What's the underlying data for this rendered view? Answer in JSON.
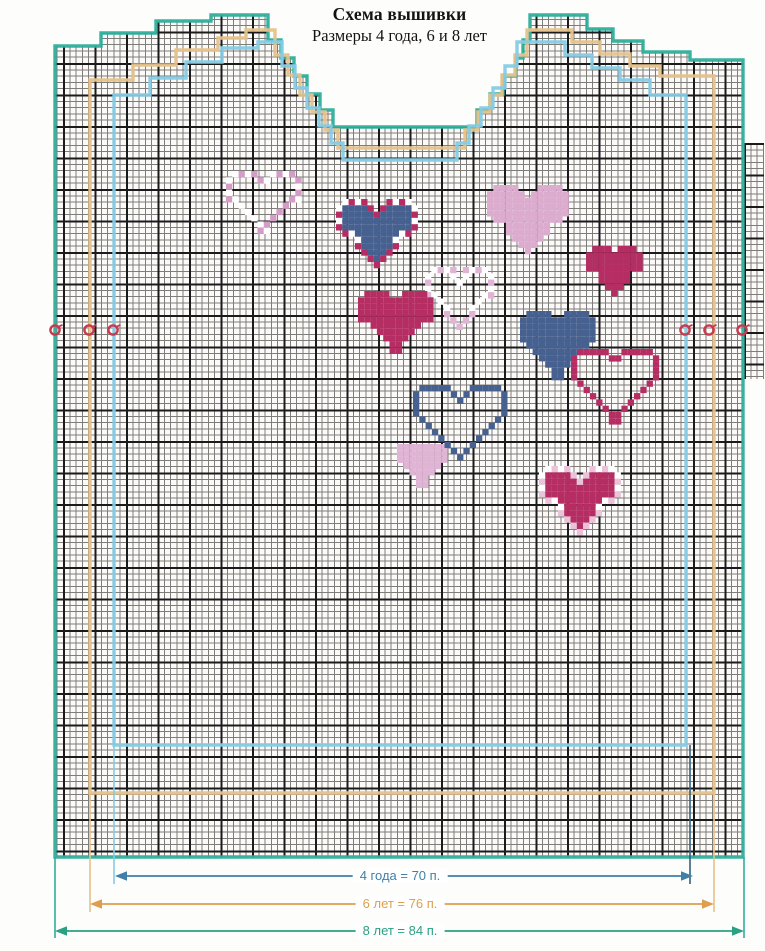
{
  "title": {
    "line1": "Схема вышивки",
    "line2": "Размеры 4 года, 6 и 8 лет"
  },
  "grid": {
    "cell_px": 6.3,
    "major_every": 5,
    "thin_color": "#7f7d7a",
    "thick_color": "#1b1b1b",
    "paper_color": "#fbfaf8"
  },
  "sizes": [
    {
      "name": "4 года",
      "stitches": "70 п.",
      "label": "4 года = 70 п.",
      "outline_color": "#85cbe4",
      "arrow_color": "#4080a8",
      "arrow": {
        "x1": 115,
        "x2": 693,
        "y": 876,
        "label_x": 400
      },
      "outline": [
        [
          114,
          745
        ],
        [
          114,
          95
        ],
        [
          150,
          95
        ],
        [
          150,
          78
        ],
        [
          186,
          78
        ],
        [
          186,
          62
        ],
        [
          222,
          62
        ],
        [
          222,
          48
        ],
        [
          258,
          48
        ],
        [
          258,
          42
        ],
        [
          282,
          42
        ],
        [
          282,
          66
        ],
        [
          295,
          66
        ],
        [
          295,
          88
        ],
        [
          307,
          88
        ],
        [
          307,
          108
        ],
        [
          319,
          108
        ],
        [
          319,
          126
        ],
        [
          331,
          126
        ],
        [
          331,
          143
        ],
        [
          343,
          143
        ],
        [
          343,
          160
        ],
        [
          457,
          160
        ],
        [
          457,
          143
        ],
        [
          469,
          143
        ],
        [
          469,
          126
        ],
        [
          481,
          126
        ],
        [
          481,
          108
        ],
        [
          493,
          108
        ],
        [
          493,
          88
        ],
        [
          505,
          88
        ],
        [
          505,
          66
        ],
        [
          517,
          66
        ],
        [
          517,
          42
        ],
        [
          565,
          42
        ],
        [
          565,
          55
        ],
        [
          592,
          55
        ],
        [
          592,
          68
        ],
        [
          620,
          68
        ],
        [
          620,
          80
        ],
        [
          650,
          80
        ],
        [
          650,
          95
        ],
        [
          686,
          95
        ],
        [
          686,
          745
        ]
      ]
    },
    {
      "name": "6 лет",
      "stitches": "76 п.",
      "label": "6 лет = 76 п.",
      "outline_color": "#e6c28b",
      "arrow_color": "#dd9f4d",
      "arrow": {
        "x1": 90,
        "x2": 714,
        "y": 904,
        "label_x": 400
      },
      "outline": [
        [
          90,
          793
        ],
        [
          90,
          80
        ],
        [
          133,
          80
        ],
        [
          133,
          65
        ],
        [
          176,
          65
        ],
        [
          176,
          50
        ],
        [
          218,
          50
        ],
        [
          218,
          38
        ],
        [
          246,
          38
        ],
        [
          246,
          30
        ],
        [
          275,
          30
        ],
        [
          275,
          55
        ],
        [
          288,
          55
        ],
        [
          288,
          75
        ],
        [
          300,
          75
        ],
        [
          300,
          95
        ],
        [
          312,
          95
        ],
        [
          312,
          112
        ],
        [
          325,
          112
        ],
        [
          325,
          130
        ],
        [
          338,
          130
        ],
        [
          338,
          148
        ],
        [
          465,
          148
        ],
        [
          465,
          130
        ],
        [
          478,
          130
        ],
        [
          478,
          112
        ],
        [
          490,
          112
        ],
        [
          490,
          95
        ],
        [
          502,
          95
        ],
        [
          502,
          75
        ],
        [
          515,
          75
        ],
        [
          515,
          55
        ],
        [
          527,
          55
        ],
        [
          527,
          30
        ],
        [
          572,
          30
        ],
        [
          572,
          42
        ],
        [
          600,
          42
        ],
        [
          600,
          54
        ],
        [
          630,
          54
        ],
        [
          630,
          66
        ],
        [
          660,
          66
        ],
        [
          660,
          76
        ],
        [
          714,
          76
        ],
        [
          714,
          793
        ]
      ]
    },
    {
      "name": "8 лет",
      "stitches": "84 п.",
      "label": "8 лет = 84 п.",
      "outline_color": "#2fae9b",
      "arrow_color": "#2aa182",
      "arrow": {
        "x1": 55,
        "x2": 744,
        "y": 931,
        "label_x": 400
      },
      "outline": [
        [
          55,
          857
        ],
        [
          55,
          46
        ],
        [
          101,
          46
        ],
        [
          101,
          33
        ],
        [
          156,
          33
        ],
        [
          156,
          21
        ],
        [
          211,
          21
        ],
        [
          211,
          15
        ],
        [
          268,
          15
        ],
        [
          268,
          40
        ],
        [
          281,
          40
        ],
        [
          281,
          58
        ],
        [
          294,
          58
        ],
        [
          294,
          76
        ],
        [
          307,
          76
        ],
        [
          307,
          94
        ],
        [
          320,
          94
        ],
        [
          320,
          110
        ],
        [
          333,
          110
        ],
        [
          333,
          127
        ],
        [
          477,
          127
        ],
        [
          477,
          110
        ],
        [
          490,
          110
        ],
        [
          490,
          94
        ],
        [
          503,
          94
        ],
        [
          503,
          76
        ],
        [
          516,
          76
        ],
        [
          516,
          58
        ],
        [
          523,
          58
        ],
        [
          523,
          40
        ],
        [
          530,
          40
        ],
        [
          530,
          15
        ],
        [
          587,
          15
        ],
        [
          587,
          29
        ],
        [
          613,
          29
        ],
        [
          613,
          41
        ],
        [
          643,
          41
        ],
        [
          643,
          52
        ],
        [
          690,
          52
        ],
        [
          690,
          60
        ],
        [
          743,
          60
        ],
        [
          743,
          857
        ]
      ]
    }
  ],
  "guides": [
    {
      "x": 55,
      "y1": 857,
      "y2": 938,
      "color": "#2fae9b"
    },
    {
      "x": 744,
      "y1": 857,
      "y2": 938,
      "color": "#2fae9b"
    },
    {
      "x": 90,
      "y1": 793,
      "y2": 912,
      "color": "#e6c28b"
    },
    {
      "x": 714,
      "y1": 793,
      "y2": 912,
      "color": "#e6c28b"
    },
    {
      "x": 114,
      "y1": 745,
      "y2": 884,
      "color": "#85cbe4"
    },
    {
      "x": 690,
      "y1": 745,
      "y2": 884,
      "color": "#33617f"
    }
  ],
  "markers": {
    "color": "#c73b4f",
    "radius": 4.6,
    "positions": [
      {
        "x": 55,
        "y": 330
      },
      {
        "x": 89,
        "y": 330
      },
      {
        "x": 113,
        "y": 330
      },
      {
        "x": 685,
        "y": 330
      },
      {
        "x": 709,
        "y": 330
      },
      {
        "x": 742,
        "y": 330
      }
    ]
  },
  "heart_colors": {
    "magenta": "#b52d62",
    "navy": "#46608f",
    "light_pink": "#e0b4d4",
    "pink": "#d49cc6",
    "white": "#ffffff"
  },
  "hearts": [
    {
      "x": 226,
      "y": 171,
      "cols": 12,
      "rows": 10,
      "style": "checker_outline",
      "color": "#d49cc6"
    },
    {
      "x": 336,
      "y": 199,
      "cols": 13,
      "rows": 11,
      "style": "checker",
      "fill": "#46608f",
      "border": "#b52d62"
    },
    {
      "x": 487,
      "y": 185,
      "cols": 13,
      "rows": 11,
      "style": "solid",
      "color": "#dcaccf"
    },
    {
      "x": 586,
      "y": 246,
      "cols": 9,
      "rows": 8,
      "style": "solid",
      "color": "#b52d62"
    },
    {
      "x": 425,
      "y": 267,
      "cols": 11,
      "rows": 10,
      "style": "checker_outline",
      "color": "#e0b4d4"
    },
    {
      "x": 358,
      "y": 291,
      "cols": 12,
      "rows": 10,
      "style": "solid",
      "color": "#b52d62"
    },
    {
      "x": 520,
      "y": 311,
      "cols": 12,
      "rows": 11,
      "style": "solid",
      "color": "#46608f"
    },
    {
      "x": 571,
      "y": 349,
      "cols": 14,
      "rows": 12,
      "style": "outline",
      "color": "#b52d62"
    },
    {
      "x": 397,
      "y": 444,
      "cols": 8,
      "rows": 7,
      "style": "solid",
      "color": "#e0b4d4"
    },
    {
      "x": 413,
      "y": 385,
      "cols": 15,
      "rows": 12,
      "style": "outline",
      "color": "#46608f"
    },
    {
      "x": 539,
      "y": 466,
      "cols": 13,
      "rows": 11,
      "style": "checker",
      "fill": "#b52d62",
      "border": "#eac3da"
    }
  ]
}
